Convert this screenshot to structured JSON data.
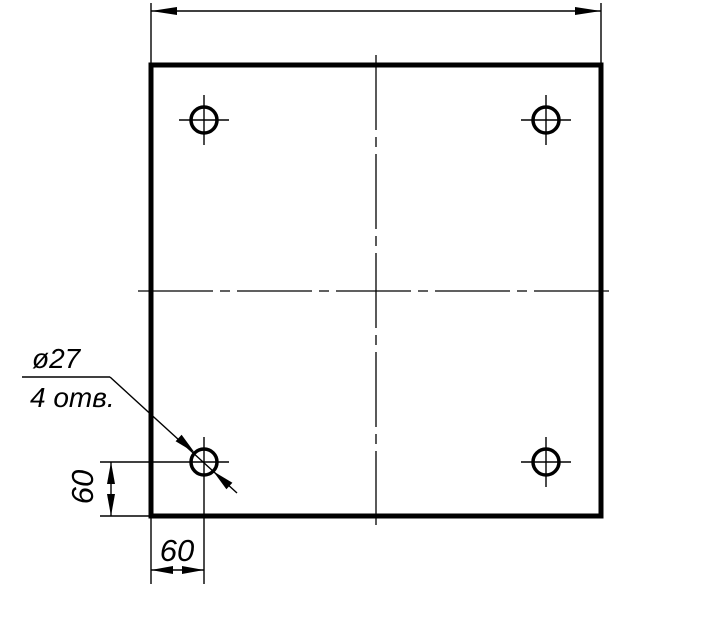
{
  "colors": {
    "ink": "#000000",
    "paper": "#ffffff"
  },
  "callout": {
    "diameter_label": "ø27",
    "count_label": "4 отв."
  },
  "dimensions": {
    "overall_width_label": "",
    "hole_offset_horizontal": "60",
    "hole_offset_vertical": "60"
  }
}
